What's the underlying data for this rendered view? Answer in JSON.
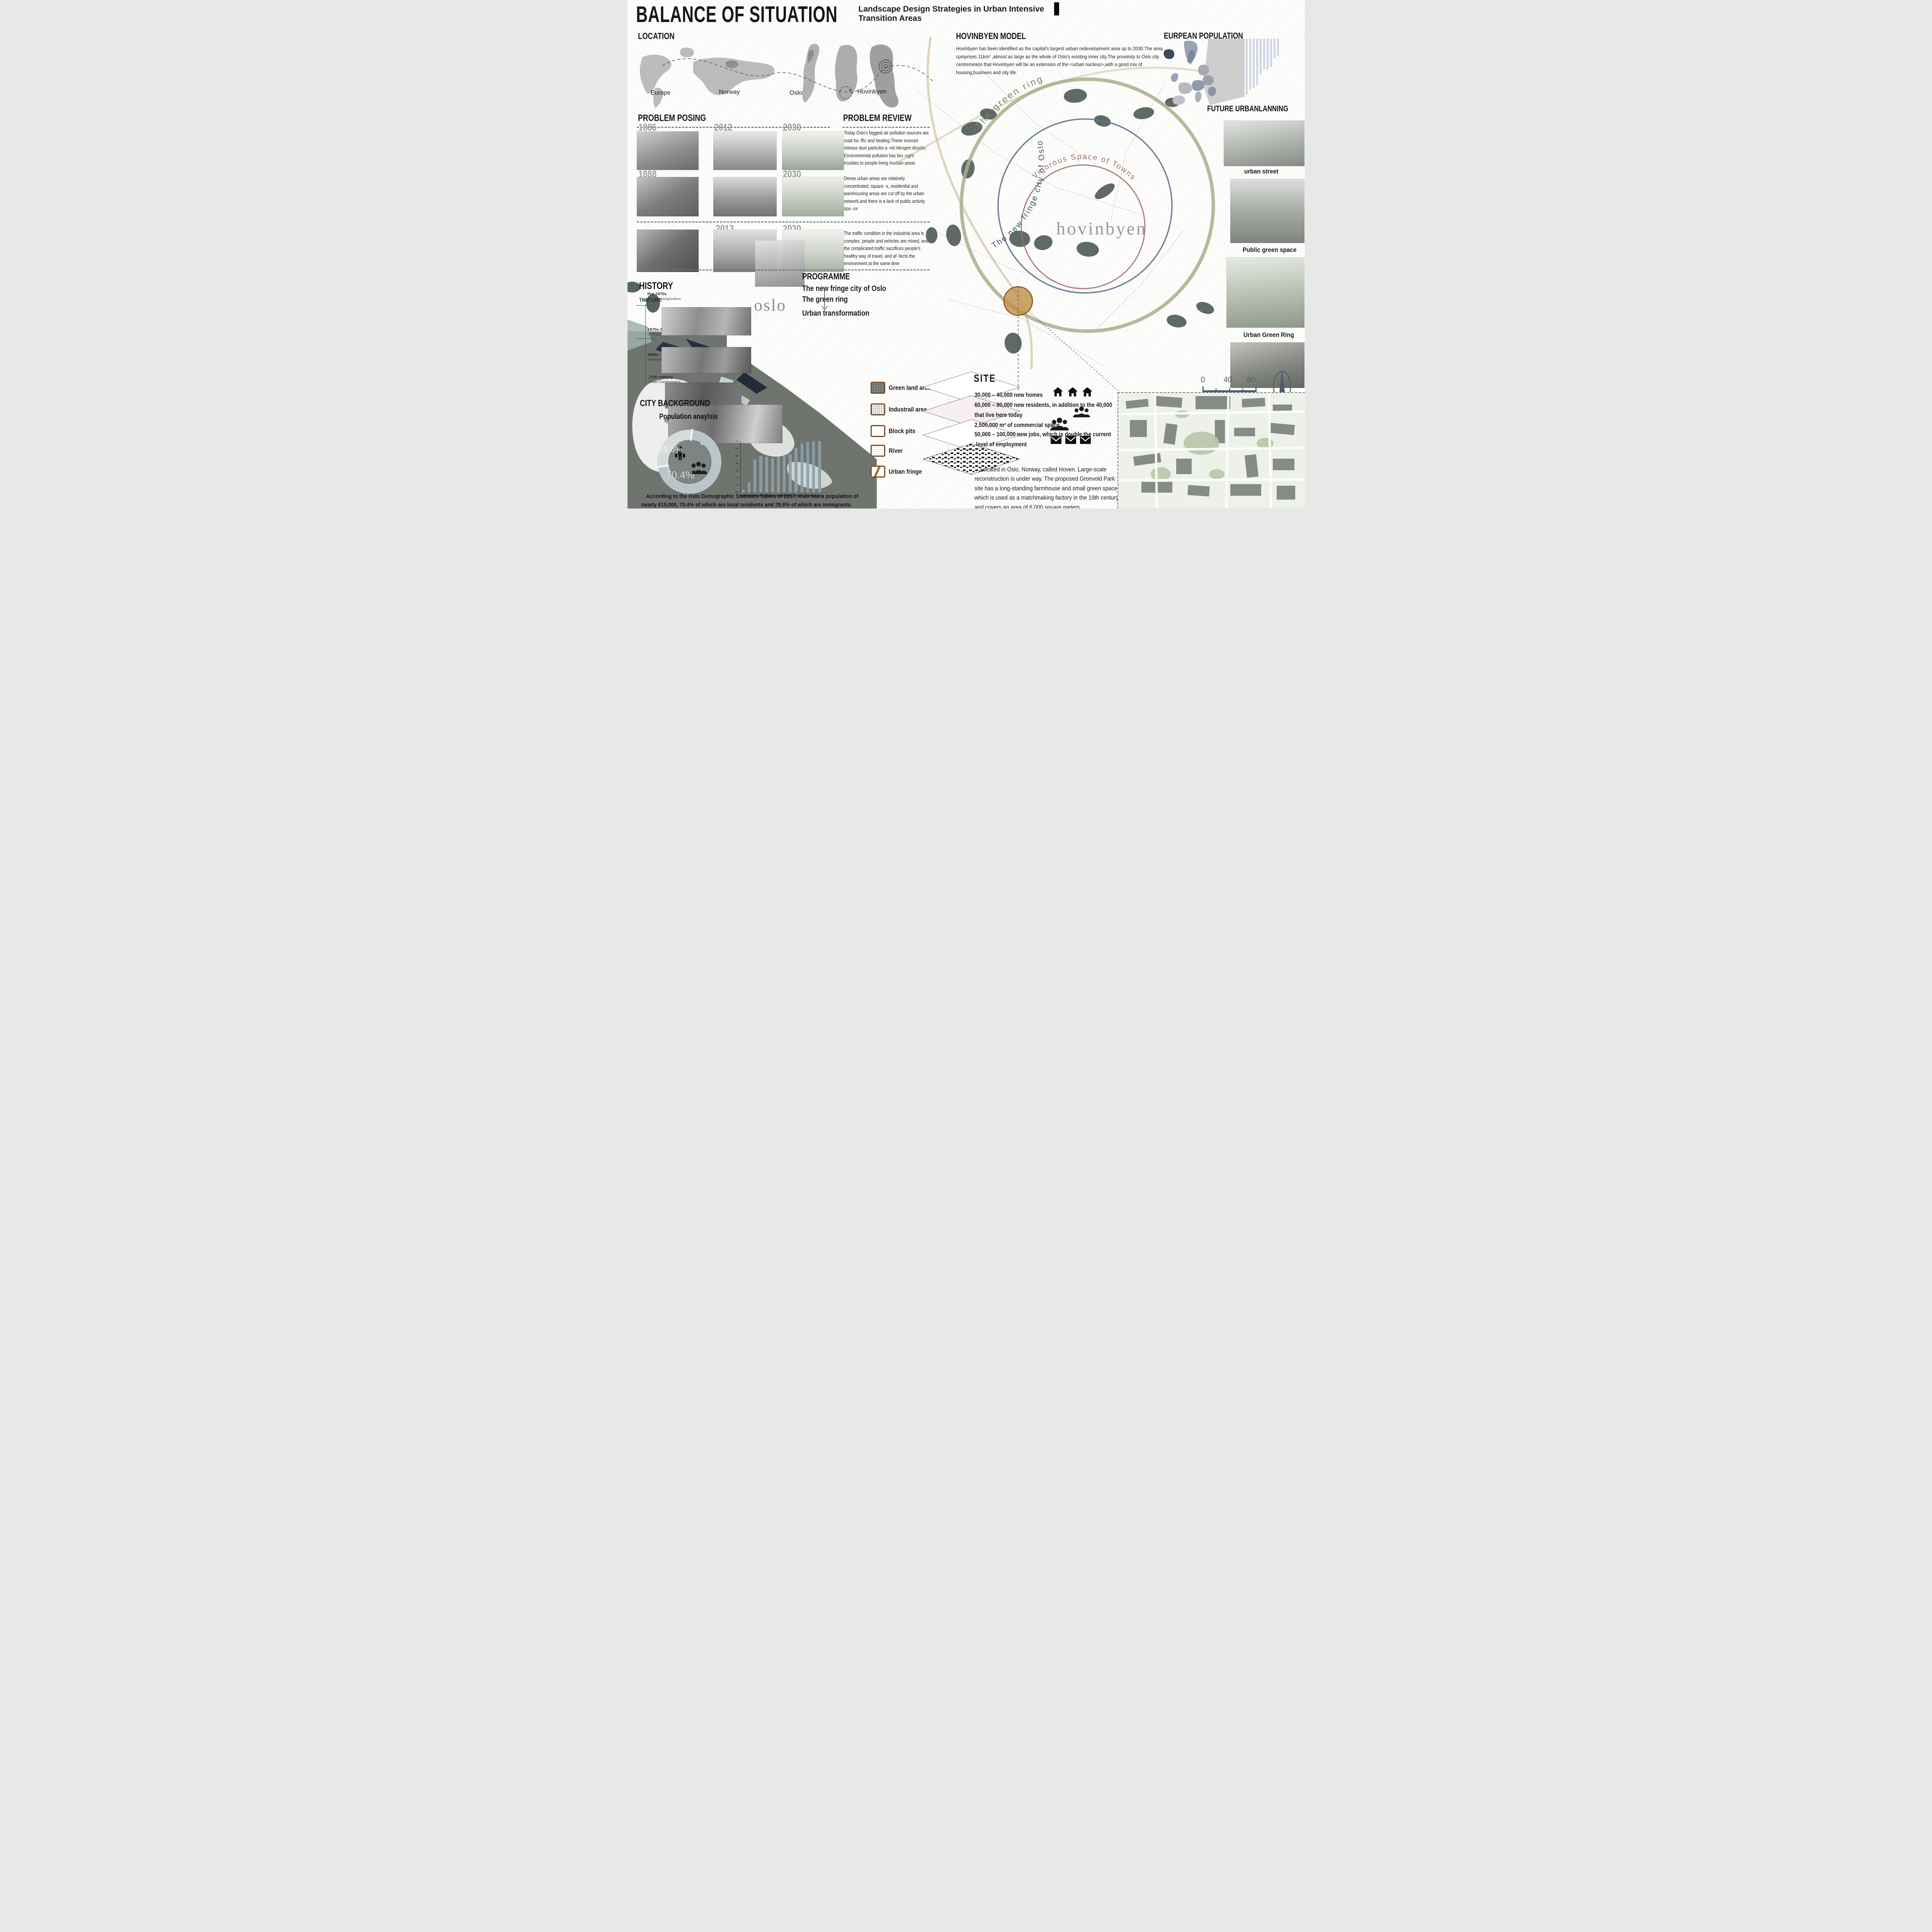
{
  "board": {
    "title": "BALANCE  OF  SITUATION",
    "subtitle_line1": "Landscape Design Strategies in Urban Intensive",
    "subtitle_line2": "Transition Areas"
  },
  "location": {
    "heading": "LOCATION",
    "labels": [
      "Europe",
      "Norway",
      "Oslo",
      "Hovinbyen"
    ]
  },
  "problem_posing": {
    "heading": "PROBLEM  POSING",
    "rows": [
      {
        "years": [
          "1886",
          "2012",
          "2030"
        ]
      },
      {
        "years": [
          "1888",
          "2030"
        ]
      },
      {
        "years": [
          "2013",
          "2030"
        ]
      }
    ]
  },
  "problem_review": {
    "heading": "PROBLEM   REVIEW",
    "paragraphs": [
      "Today Oslo's biggest air pollution sources are road tra -ffic and heating.These sources release dust particles a -nd nitrogen dioxide. Environmental pollution has bro -ught troubles to people living inurban areas",
      "Dense urban areas are relatively concentrated, square -s, residential and warehousing areas are cut off by the urban network,and there is a lack of public activity spa -ce",
      "The traffic condition in the industrial area is complex, people and vehicles are mixed, and the complicated traffic sacrifices people's healthy way of travel, and af -fects the environment at the same time"
    ]
  },
  "hovinbyen_model": {
    "heading": "HOVINBYEN MODEL",
    "body": "Hovinbyen has been identified as the capital's largest ueban redevelopment area up to 2030.The area cpmprises 11km² ,almost as large as the whole of Oslo's existing inner city.The proximity to Oslo city centremeans that Hovinbyen will be an extension of the <urban nucleus>,with a good mix of housing,businees and city life."
  },
  "european_population": {
    "heading": "EURPEAN POPULATION"
  },
  "future_urbanplanning": {
    "heading": "FUTURE URBANLANNING"
  },
  "right_labels": [
    "urban street",
    "Public green space",
    "Urban Green Ring"
  ],
  "central_map": {
    "ring_labels": {
      "green": "The  green  ring",
      "blue": "The new fringe city of Oslo",
      "red": "Vigorous Space of Towns"
    },
    "area_label": "hovinbyen"
  },
  "programme": {
    "heading": "PROGRAMME",
    "items": [
      "The new fringe city of Oslo",
      "The  green ring",
      "Urban transformation"
    ]
  },
  "history": {
    "heading": "HISTORY",
    "timeline_label": "TIME LINE",
    "entries": [
      {
        "period": "Pre-1970s",
        "label": "Navigation&Agriculture"
      },
      {
        "period": "1970s-1980s",
        "label": "Oil &Gas Extraction"
      },
      {
        "period": "1990s",
        "label": "Industrialization"
      },
      {
        "period": "21th century",
        "label": "Urban Transformation"
      }
    ],
    "oslo_label": "oslo"
  },
  "city_background": {
    "heading": "CITY  BACKGROUND",
    "subheading": "Population  anaylsis",
    "caption_line1": "According to the Oslo Demographic Statistics Tables of 2017, Oslo has a population of",
    "caption_line2": "nearly 615,000, 70.4% of which are local residents and 29.6% of which are immigrants."
  },
  "legend": {
    "items": [
      "Green land area",
      "Industrail area",
      "Block pits",
      "River",
      "Urban fringe"
    ]
  },
  "site": {
    "heading": "SITE",
    "stats": [
      "30,000 – 40,000 new homes",
      "60,000 – 80,000 new residents, in addition to the 40,000",
      "that  live here today",
      "2,500,000 m²  of commercial space",
      "50,000 – 100,000 new jobs, which is  double the current",
      "level of employment"
    ],
    "description": "Located in Oslo, Norway, called Hoven. Large-scale reconstruction is under way. The proposed Gronvold Park site has a long-standing farmhouse and small green space, which is used as a matchmaking factory in the 19th century and covers an area of 6,000 square meters."
  },
  "scale_bar": {
    "ticks": [
      "0",
      "40",
      "80"
    ]
  },
  "colors": {
    "green_ring": "#a9ae8b",
    "fringe_ring": "#5d7391",
    "vigorous_ring": "#9b6f70",
    "site_marker": "#c18f45",
    "legend_border": "#7a4a22",
    "scale_compass": "#4d5c6b",
    "green_land_blob": "#57635d"
  },
  "chart_data": [
    {
      "type": "bar",
      "title": "Oslo population by year",
      "categories": [
        "1800",
        "1801",
        "1850",
        "1890",
        "1951",
        "1961",
        "1971",
        "1981",
        "1991",
        "2001",
        "2011",
        "2014",
        "2015",
        "2016"
      ],
      "values": [
        0.3,
        1.4,
        4.5,
        5.0,
        4.9,
        4.7,
        4.9,
        5.0,
        5.2,
        6.1,
        6.7,
        6.9,
        7.0,
        7.0
      ],
      "xlabel": "year",
      "ylabel": "population (x100,000)",
      "ylim": [
        0,
        7
      ],
      "yticks": [
        "0",
        "1",
        "2",
        "3",
        "4",
        "5",
        "6",
        "7"
      ],
      "legend_position": "none",
      "grid": false
    },
    {
      "type": "pie",
      "title": "Population anaylsis",
      "labels": [
        "immigrants",
        "local residents"
      ],
      "values": [
        29.6,
        70.4
      ],
      "display": [
        "29.6%",
        "70.4%"
      ]
    },
    {
      "type": "bar",
      "title": "Eurpean population country bars (labels illegible)",
      "categories": [
        "",
        "",
        "",
        "",
        "",
        "",
        "",
        "",
        "",
        ""
      ],
      "values": [
        145,
        132,
        128,
        121,
        92,
        80,
        80,
        74,
        50,
        45
      ],
      "note": "bar lengths in px, hanging from top"
    }
  ]
}
